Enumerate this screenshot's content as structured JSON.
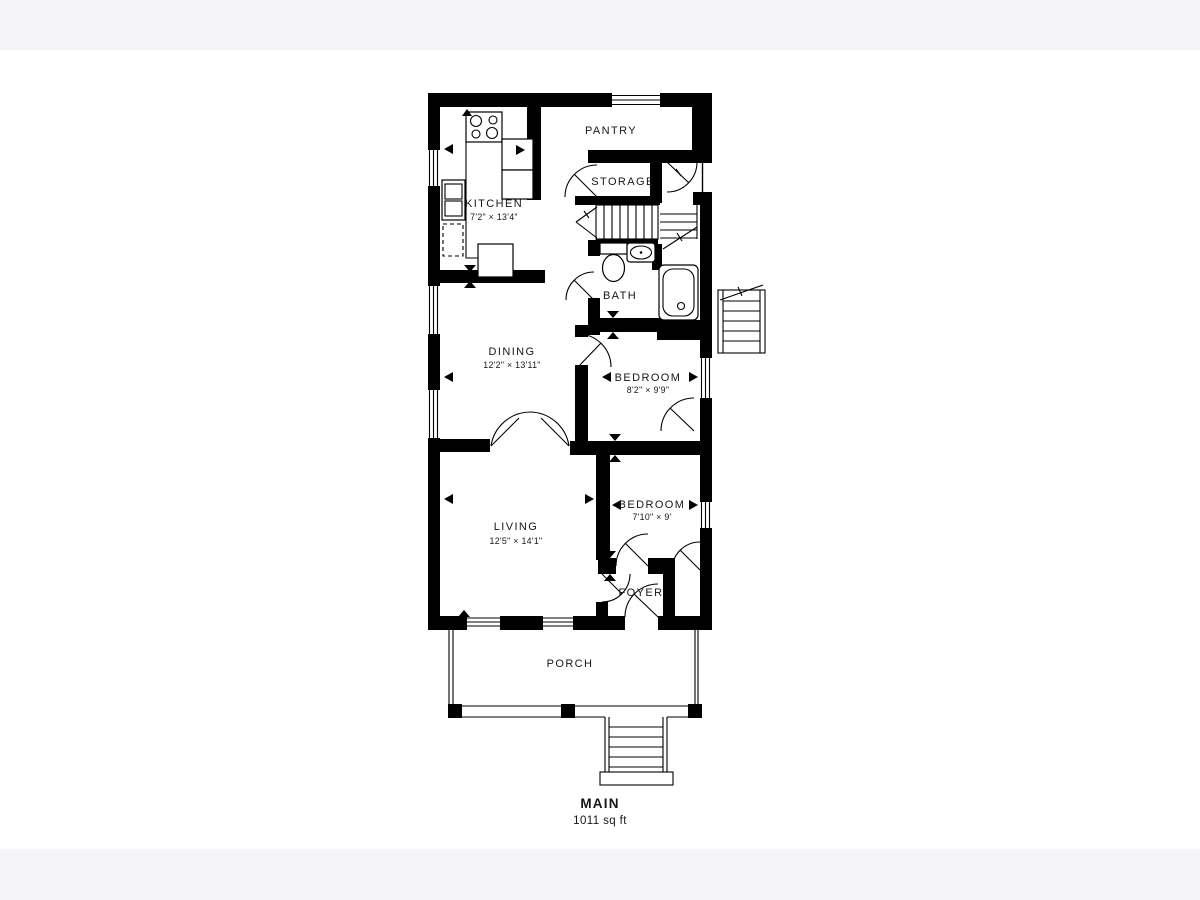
{
  "page": {
    "background_color": "#ffffff",
    "letterbox_band_color": "#f5f4f6",
    "wall_color": "#000000",
    "text_color": "#161616"
  },
  "floorplan": {
    "floor_label": "MAIN",
    "floor_area": "1011 sq ft",
    "rooms": [
      {
        "id": "kitchen",
        "name": "KITCHEN",
        "dims": "7'2\" × 13'4\""
      },
      {
        "id": "pantry",
        "name": "PANTRY",
        "dims": ""
      },
      {
        "id": "storage",
        "name": "STORAGE",
        "dims": ""
      },
      {
        "id": "bath",
        "name": "BATH",
        "dims": ""
      },
      {
        "id": "dining",
        "name": "DINING",
        "dims": "12'2\" × 13'11\""
      },
      {
        "id": "bedroom1",
        "name": "BEDROOM",
        "dims": "8'2\" × 9'9\""
      },
      {
        "id": "living",
        "name": "LIVING",
        "dims": "12'5\" × 14'1\""
      },
      {
        "id": "bedroom2",
        "name": "BEDROOM",
        "dims": "7'10\" × 9'"
      },
      {
        "id": "foyer",
        "name": "FOYER",
        "dims": ""
      },
      {
        "id": "porch",
        "name": "PORCH",
        "dims": ""
      }
    ],
    "fixtures": [
      "stove-icon",
      "kitchen-sink-icon",
      "dishwasher-icon",
      "kitchen-island-icon",
      "toilet-icon",
      "bath-sink-icon",
      "bathtub-icon",
      "stairs-icon",
      "exterior-stairs-icon",
      "front-steps-icon",
      "porch-posts"
    ]
  }
}
